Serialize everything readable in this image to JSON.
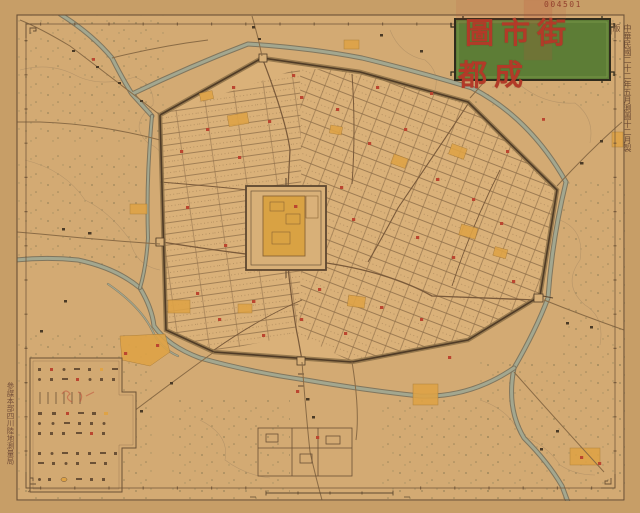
{
  "document": {
    "kind": "historical city map (scanned print)",
    "serial_number": "004501",
    "title": "成都街市圖",
    "title_display_rtl": "圖市街都成",
    "edition_note_vertical": "中華民國二十二年五月測圖十二月製版",
    "agency_note_vertical": "參謀本部四川陸地測量局"
  },
  "colors": {
    "margin_paper": "#c79e67",
    "map_field": "#d3aa73",
    "inner_city": "#dab179",
    "ink_brown": "#6b5136",
    "street_brown": "#8a6a46",
    "river_fill": "#a3a78f",
    "river_edge": "#77705c",
    "built_block_orange": "#dfa345",
    "landmark_red": "#bb4630",
    "title_panel_green": "#5d7d36",
    "title_text_red": "#b23a28",
    "stamp_red": "#c0503a"
  },
  "legend": {
    "location": "bottom-left",
    "symbol_rows": 10
  },
  "scale_bar": {
    "location": "bottom-center-inside-border"
  }
}
